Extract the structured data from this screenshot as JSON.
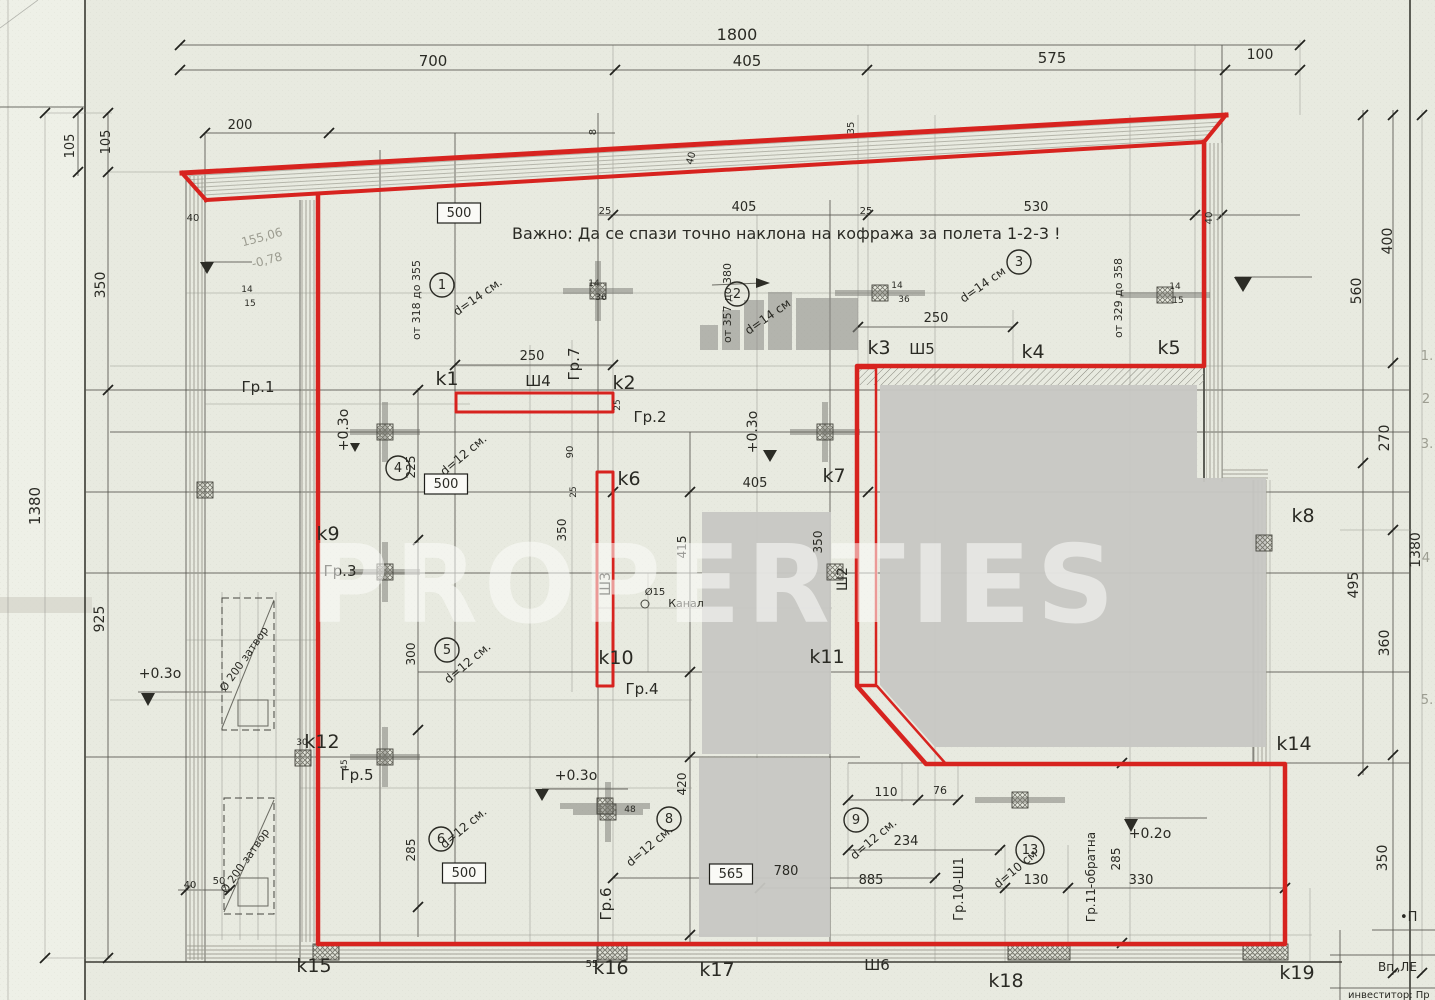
{
  "watermark": {
    "text": "PROPERTIES"
  },
  "colors": {
    "red": "#d7231f",
    "paper": "#e8eae0",
    "gray_block": "#c8c8c3"
  },
  "note": {
    "text": "Важно: Да се спази точно наклона на кофража за полета 1-2-3 !"
  },
  "boxed_values": [
    "500",
    "500",
    "500",
    "565"
  ],
  "labels": [
    {
      "t": "1800",
      "x": 737,
      "y": 40,
      "s": 16
    },
    {
      "t": "700",
      "x": 433,
      "y": 66,
      "s": 15
    },
    {
      "t": "405",
      "x": 747,
      "y": 66,
      "s": 15
    },
    {
      "t": "575",
      "x": 1052,
      "y": 63,
      "s": 15
    },
    {
      "t": "100",
      "x": 1260,
      "y": 59,
      "s": 14
    },
    {
      "t": "200",
      "x": 240,
      "y": 129,
      "s": 13
    },
    {
      "t": "105",
      "x": 74,
      "y": 146,
      "r": -90,
      "s": 13
    },
    {
      "t": "105",
      "x": 110,
      "y": 142,
      "r": -90,
      "s": 13
    },
    {
      "t": "350",
      "x": 105,
      "y": 285,
      "r": -90,
      "s": 14
    },
    {
      "t": "925",
      "x": 104,
      "y": 619,
      "r": -90,
      "s": 14
    },
    {
      "t": "1380",
      "x": 40,
      "y": 506,
      "r": -90,
      "s": 15
    },
    {
      "t": "40",
      "x": 193,
      "y": 221,
      "s": 10
    },
    {
      "t": "14",
      "x": 247,
      "y": 292,
      "s": 9
    },
    {
      "t": "15",
      "x": 250,
      "y": 306,
      "s": 9
    },
    {
      "t": "155,06",
      "x": 263,
      "y": 241,
      "r": -15,
      "s": 12,
      "st": "pencil"
    },
    {
      "t": "-0,78",
      "x": 268,
      "y": 264,
      "r": -15,
      "s": 12,
      "st": "pencil"
    },
    {
      "t": "8",
      "x": 596,
      "y": 132,
      "r": -90,
      "s": 10
    },
    {
      "t": "40",
      "x": 694,
      "y": 159,
      "r": -75,
      "s": 10
    },
    {
      "t": "35",
      "x": 854,
      "y": 128,
      "r": -90,
      "s": 10
    },
    {
      "t": "25",
      "x": 605,
      "y": 214,
      "s": 10
    },
    {
      "t": "405",
      "x": 744,
      "y": 211,
      "s": 13
    },
    {
      "t": "25",
      "x": 866,
      "y": 214,
      "s": 10
    },
    {
      "t": "530",
      "x": 1036,
      "y": 211,
      "s": 13
    },
    {
      "t": "40",
      "x": 1212,
      "y": 218,
      "r": -90,
      "s": 10
    },
    {
      "t": "400",
      "x": 1392,
      "y": 241,
      "r": -90,
      "s": 14
    },
    {
      "t": "560",
      "x": 1361,
      "y": 291,
      "r": -90,
      "s": 14
    },
    {
      "t": "270",
      "x": 1389,
      "y": 438,
      "r": -90,
      "s": 14
    },
    {
      "t": "495",
      "x": 1358,
      "y": 585,
      "r": -90,
      "s": 14
    },
    {
      "t": "360",
      "x": 1389,
      "y": 643,
      "r": -90,
      "s": 14
    },
    {
      "t": "1380",
      "x": 1420,
      "y": 550,
      "r": -90,
      "s": 14
    },
    {
      "t": "350",
      "x": 1387,
      "y": 858,
      "r": -90,
      "s": 14
    },
    {
      "t": "Важно: Да се спази точно наклона на кофража за полета 1-2-3 !",
      "x": 512,
      "y": 239,
      "s": 16,
      "a": "s"
    },
    {
      "t": "1",
      "x": 442,
      "y": 289,
      "st": "circle"
    },
    {
      "t": "2",
      "x": 737,
      "y": 298,
      "st": "circle"
    },
    {
      "t": "3",
      "x": 1019,
      "y": 266,
      "st": "circle"
    },
    {
      "t": "4",
      "x": 398,
      "y": 472,
      "st": "circle"
    },
    {
      "t": "5",
      "x": 447,
      "y": 654,
      "st": "circle"
    },
    {
      "t": "6",
      "x": 441,
      "y": 843,
      "st": "circle"
    },
    {
      "t": "8",
      "x": 669,
      "y": 823,
      "st": "circle"
    },
    {
      "t": "9",
      "x": 856,
      "y": 824,
      "st": "circle"
    },
    {
      "t": "13",
      "x": 1030,
      "y": 854,
      "st": "circle"
    },
    {
      "t": "d=14 см.",
      "x": 480,
      "y": 300,
      "r": -35,
      "s": 12
    },
    {
      "t": "d=14 см",
      "x": 770,
      "y": 320,
      "r": -35,
      "s": 12
    },
    {
      "t": "d=14 см",
      "x": 985,
      "y": 288,
      "r": -35,
      "s": 12
    },
    {
      "t": "d=12 см.",
      "x": 466,
      "y": 458,
      "r": -40,
      "s": 12
    },
    {
      "t": "d=12 см.",
      "x": 470,
      "y": 666,
      "r": -40,
      "s": 12
    },
    {
      "t": "d=12 см.",
      "x": 466,
      "y": 831,
      "r": -40,
      "s": 12
    },
    {
      "t": "d=12 см.",
      "x": 652,
      "y": 849,
      "r": -40,
      "s": 12
    },
    {
      "t": "d=12 см.",
      "x": 876,
      "y": 842,
      "r": -40,
      "s": 12
    },
    {
      "t": "d=10 см",
      "x": 1018,
      "y": 872,
      "r": -40,
      "s": 12
    },
    {
      "t": "от 318 до 355",
      "x": 420,
      "y": 300,
      "r": -90,
      "s": 11
    },
    {
      "t": "от 357 до 380",
      "x": 731,
      "y": 303,
      "r": -90,
      "s": 11
    },
    {
      "t": "от 329 до 358",
      "x": 1122,
      "y": 298,
      "r": -90,
      "s": 11
    },
    {
      "t": "Гр.1",
      "x": 258,
      "y": 392,
      "s": 15
    },
    {
      "t": "Гр.2",
      "x": 650,
      "y": 422,
      "s": 15
    },
    {
      "t": "Гр.3",
      "x": 340,
      "y": 576,
      "s": 15
    },
    {
      "t": "Гр.4",
      "x": 642,
      "y": 694,
      "s": 15
    },
    {
      "t": "Гр.5",
      "x": 357,
      "y": 780,
      "s": 15
    },
    {
      "t": "Гр.6",
      "x": 611,
      "y": 904,
      "r": -90,
      "s": 15
    },
    {
      "t": "Гр.7",
      "x": 579,
      "y": 364,
      "r": -90,
      "s": 15
    },
    {
      "t": "Гр.10-Ш1",
      "x": 963,
      "y": 889,
      "r": -90,
      "s": 13
    },
    {
      "t": "Гр.11-обратна",
      "x": 1095,
      "y": 877,
      "r": -90,
      "s": 12
    },
    {
      "t": "k1",
      "x": 447,
      "y": 385,
      "s": 19
    },
    {
      "t": "k2",
      "x": 624,
      "y": 389,
      "s": 19
    },
    {
      "t": "k3",
      "x": 879,
      "y": 354,
      "s": 19
    },
    {
      "t": "k4",
      "x": 1033,
      "y": 358,
      "s": 19
    },
    {
      "t": "k5",
      "x": 1169,
      "y": 354,
      "s": 19
    },
    {
      "t": "k6",
      "x": 629,
      "y": 485,
      "s": 19
    },
    {
      "t": "k7",
      "x": 834,
      "y": 482,
      "s": 19
    },
    {
      "t": "k8",
      "x": 1303,
      "y": 522,
      "s": 19
    },
    {
      "t": "k9",
      "x": 328,
      "y": 540,
      "s": 19
    },
    {
      "t": "k10",
      "x": 616,
      "y": 664,
      "s": 19
    },
    {
      "t": "k11",
      "x": 827,
      "y": 663,
      "s": 19
    },
    {
      "t": "k12",
      "x": 322,
      "y": 748,
      "s": 19
    },
    {
      "t": "k14",
      "x": 1294,
      "y": 750,
      "s": 19
    },
    {
      "t": "k15",
      "x": 314,
      "y": 972,
      "s": 19
    },
    {
      "t": "k16",
      "x": 611,
      "y": 974,
      "s": 19
    },
    {
      "t": "k17",
      "x": 717,
      "y": 976,
      "s": 19
    },
    {
      "t": "k18",
      "x": 1006,
      "y": 987,
      "s": 19
    },
    {
      "t": "k19",
      "x": 1297,
      "y": 979,
      "s": 19
    },
    {
      "t": "Ш4",
      "x": 538,
      "y": 386,
      "s": 15
    },
    {
      "t": "Ш5",
      "x": 922,
      "y": 354,
      "s": 15
    },
    {
      "t": "Ш3",
      "x": 610,
      "y": 584,
      "r": -90,
      "s": 14
    },
    {
      "t": "Ш2",
      "x": 847,
      "y": 579,
      "r": -90,
      "s": 14
    },
    {
      "t": "Ш6",
      "x": 877,
      "y": 970,
      "s": 15
    },
    {
      "t": "250",
      "x": 532,
      "y": 360,
      "s": 13
    },
    {
      "t": "250",
      "x": 936,
      "y": 322,
      "s": 13
    },
    {
      "t": "405",
      "x": 755,
      "y": 487,
      "s": 13
    },
    {
      "t": "415",
      "x": 686,
      "y": 547,
      "r": -90,
      "s": 12
    },
    {
      "t": "350",
      "x": 822,
      "y": 542,
      "r": -90,
      "s": 12
    },
    {
      "t": "350",
      "x": 566,
      "y": 530,
      "r": -90,
      "s": 12
    },
    {
      "t": "90",
      "x": 573,
      "y": 452,
      "r": -90,
      "s": 10
    },
    {
      "t": "225",
      "x": 415,
      "y": 467,
      "r": -90,
      "s": 12
    },
    {
      "t": "300",
      "x": 415,
      "y": 654,
      "r": -90,
      "s": 12
    },
    {
      "t": "285",
      "x": 415,
      "y": 850,
      "r": -90,
      "s": 12
    },
    {
      "t": "110",
      "x": 886,
      "y": 796,
      "s": 12
    },
    {
      "t": "76",
      "x": 940,
      "y": 794,
      "s": 11
    },
    {
      "t": "234",
      "x": 906,
      "y": 845,
      "s": 13
    },
    {
      "t": "885",
      "x": 871,
      "y": 884,
      "s": 13
    },
    {
      "t": "130",
      "x": 1036,
      "y": 884,
      "s": 13
    },
    {
      "t": "330",
      "x": 1141,
      "y": 884,
      "s": 13
    },
    {
      "t": "780",
      "x": 786,
      "y": 875,
      "s": 13
    },
    {
      "t": "420",
      "x": 686,
      "y": 784,
      "r": -90,
      "s": 12
    },
    {
      "t": "285",
      "x": 1120,
      "y": 859,
      "r": -90,
      "s": 12
    },
    {
      "t": "55",
      "x": 592,
      "y": 967,
      "s": 10
    },
    {
      "t": "40",
      "x": 190,
      "y": 888,
      "s": 10
    },
    {
      "t": "50",
      "x": 219,
      "y": 884,
      "s": 10
    },
    {
      "t": "25",
      "x": 576,
      "y": 492,
      "r": -90,
      "s": 9
    },
    {
      "t": "25",
      "x": 620,
      "y": 405,
      "r": -90,
      "s": 9
    },
    {
      "t": "48",
      "x": 630,
      "y": 812,
      "s": 9
    },
    {
      "t": "14",
      "x": 594,
      "y": 286,
      "s": 9
    },
    {
      "t": "36",
      "x": 601,
      "y": 300,
      "s": 9
    },
    {
      "t": "14",
      "x": 897,
      "y": 288,
      "s": 9
    },
    {
      "t": "36",
      "x": 904,
      "y": 302,
      "s": 9
    },
    {
      "t": "14",
      "x": 1175,
      "y": 289,
      "s": 9
    },
    {
      "t": "15",
      "x": 1178,
      "y": 303,
      "s": 9
    },
    {
      "t": "30",
      "x": 302,
      "y": 745,
      "s": 9
    },
    {
      "t": "45",
      "x": 347,
      "y": 765,
      "r": -90,
      "s": 9
    },
    {
      "t": "+0.3о",
      "x": 348,
      "y": 430,
      "r": -90,
      "s": 14
    },
    {
      "t": "+0.3о",
      "x": 160,
      "y": 678,
      "s": 14
    },
    {
      "t": "+0.3о",
      "x": 576,
      "y": 780,
      "s": 14
    },
    {
      "t": "+0.2о",
      "x": 1150,
      "y": 838,
      "s": 14
    },
    {
      "t": "+0.3о",
      "x": 757,
      "y": 432,
      "r": -90,
      "s": 14
    },
    {
      "t": "Ø15",
      "x": 655,
      "y": 595,
      "s": 10
    },
    {
      "t": "Канал",
      "x": 686,
      "y": 607,
      "s": 11
    },
    {
      "t": "Ø 200 затвор",
      "x": 247,
      "y": 661,
      "r": -55,
      "s": 11
    },
    {
      "t": "Ø 200 затвор",
      "x": 248,
      "y": 863,
      "r": -55,
      "s": 11
    },
    {
      "t": "1.",
      "x": 1427,
      "y": 360,
      "s": 13,
      "st": "pencil"
    },
    {
      "t": "2",
      "x": 1426,
      "y": 403,
      "s": 13,
      "st": "pencil"
    },
    {
      "t": "3.",
      "x": 1427,
      "y": 448,
      "s": 13,
      "st": "pencil"
    },
    {
      "t": "4",
      "x": 1426,
      "y": 562,
      "s": 13,
      "st": "pencil"
    },
    {
      "t": "5.",
      "x": 1427,
      "y": 704,
      "s": 13,
      "st": "pencil"
    },
    {
      "t": "•П",
      "x": 1400,
      "y": 921,
      "s": 13,
      "a": "s"
    },
    {
      "t": "Вп„ЛЕ",
      "x": 1378,
      "y": 971,
      "s": 12,
      "a": "s"
    },
    {
      "t": "инвеститор: Пр",
      "x": 1348,
      "y": 998,
      "s": 10,
      "a": "s"
    },
    {
      "t": "500",
      "x": 459,
      "y": 217,
      "st": "box"
    },
    {
      "t": "500",
      "x": 446,
      "y": 488,
      "st": "box"
    },
    {
      "t": "500",
      "x": 464,
      "y": 877,
      "st": "box"
    },
    {
      "t": "565",
      "x": 731,
      "y": 878,
      "st": "box"
    }
  ]
}
